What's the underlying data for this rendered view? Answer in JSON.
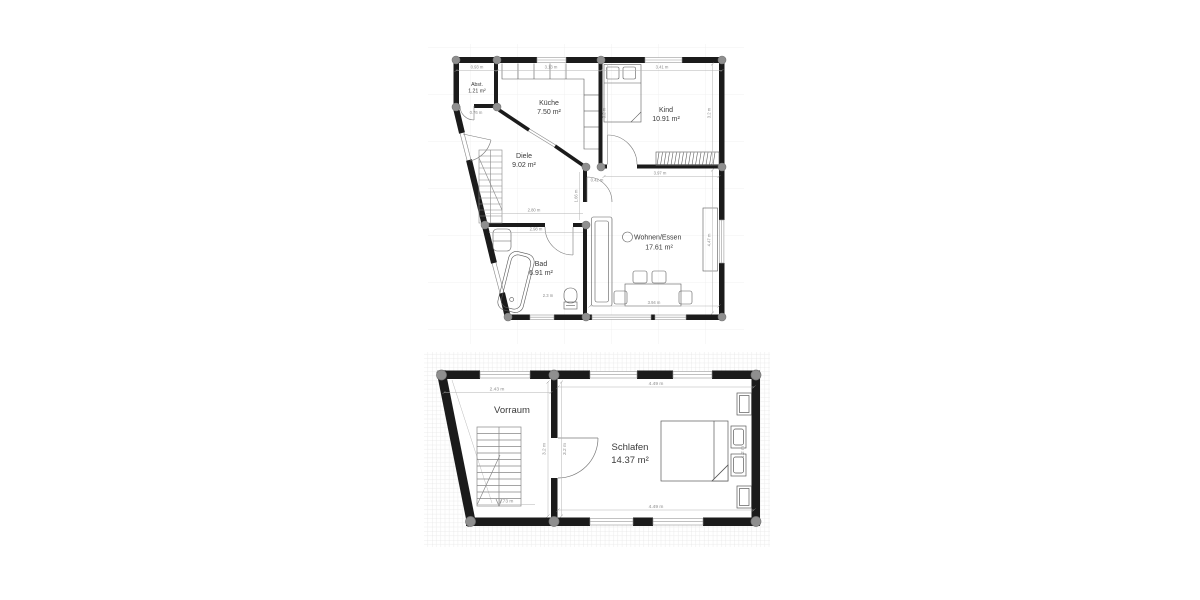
{
  "drawing": {
    "kind": "floor-plan",
    "floors": [
      {
        "rooms": [
          {
            "name": "Abst.",
            "area": "1.21 m²"
          },
          {
            "name": "Küche",
            "area": "7.50 m²"
          },
          {
            "name": "Kind",
            "area": "10.91 m²"
          },
          {
            "name": "Diele",
            "area": "9.02 m²"
          },
          {
            "name": "Bad",
            "area": "6.91 m²"
          },
          {
            "name": "Wohnen/Essen",
            "area": "17.61 m²"
          }
        ],
        "dims": {
          "top_left": "0.93 m",
          "top_mid": "3.13 m",
          "top_right": "3.41 m",
          "left": "0.76 m",
          "kind_left": "3.2 m",
          "kind_right": "3.2 m",
          "diele_width": "2.80 m",
          "diele_right": "1.66 m",
          "bad_top": "2.98 m",
          "bad_bottom": "2.3 m",
          "wohnen_top": "3.97 m",
          "wohnen_top_small": "0.42 m",
          "wohnen_bottom": "3.94 m",
          "wohnen_right": "4.47 m"
        }
      },
      {
        "rooms": [
          {
            "name": "Vorraum"
          },
          {
            "name": "Schlafen",
            "area": "14.37 m²"
          }
        ],
        "dims": {
          "top_left": "2.43 m",
          "top_right": "4.49 m",
          "bottom_left": "1.73 m",
          "bottom_right": "4.49 m",
          "wall_left": "3.2 m",
          "wall_right": "3.2 m",
          "bed_right": "1.2 m"
        }
      }
    ],
    "colors": {
      "wall": "#1b1b1b",
      "column": "#8f8f8f",
      "furniture_line": "#5a5a5a",
      "dim_text": "#8a8a8a",
      "grid_fine": "#ececec",
      "grid_large": "#f0f0f0"
    }
  }
}
